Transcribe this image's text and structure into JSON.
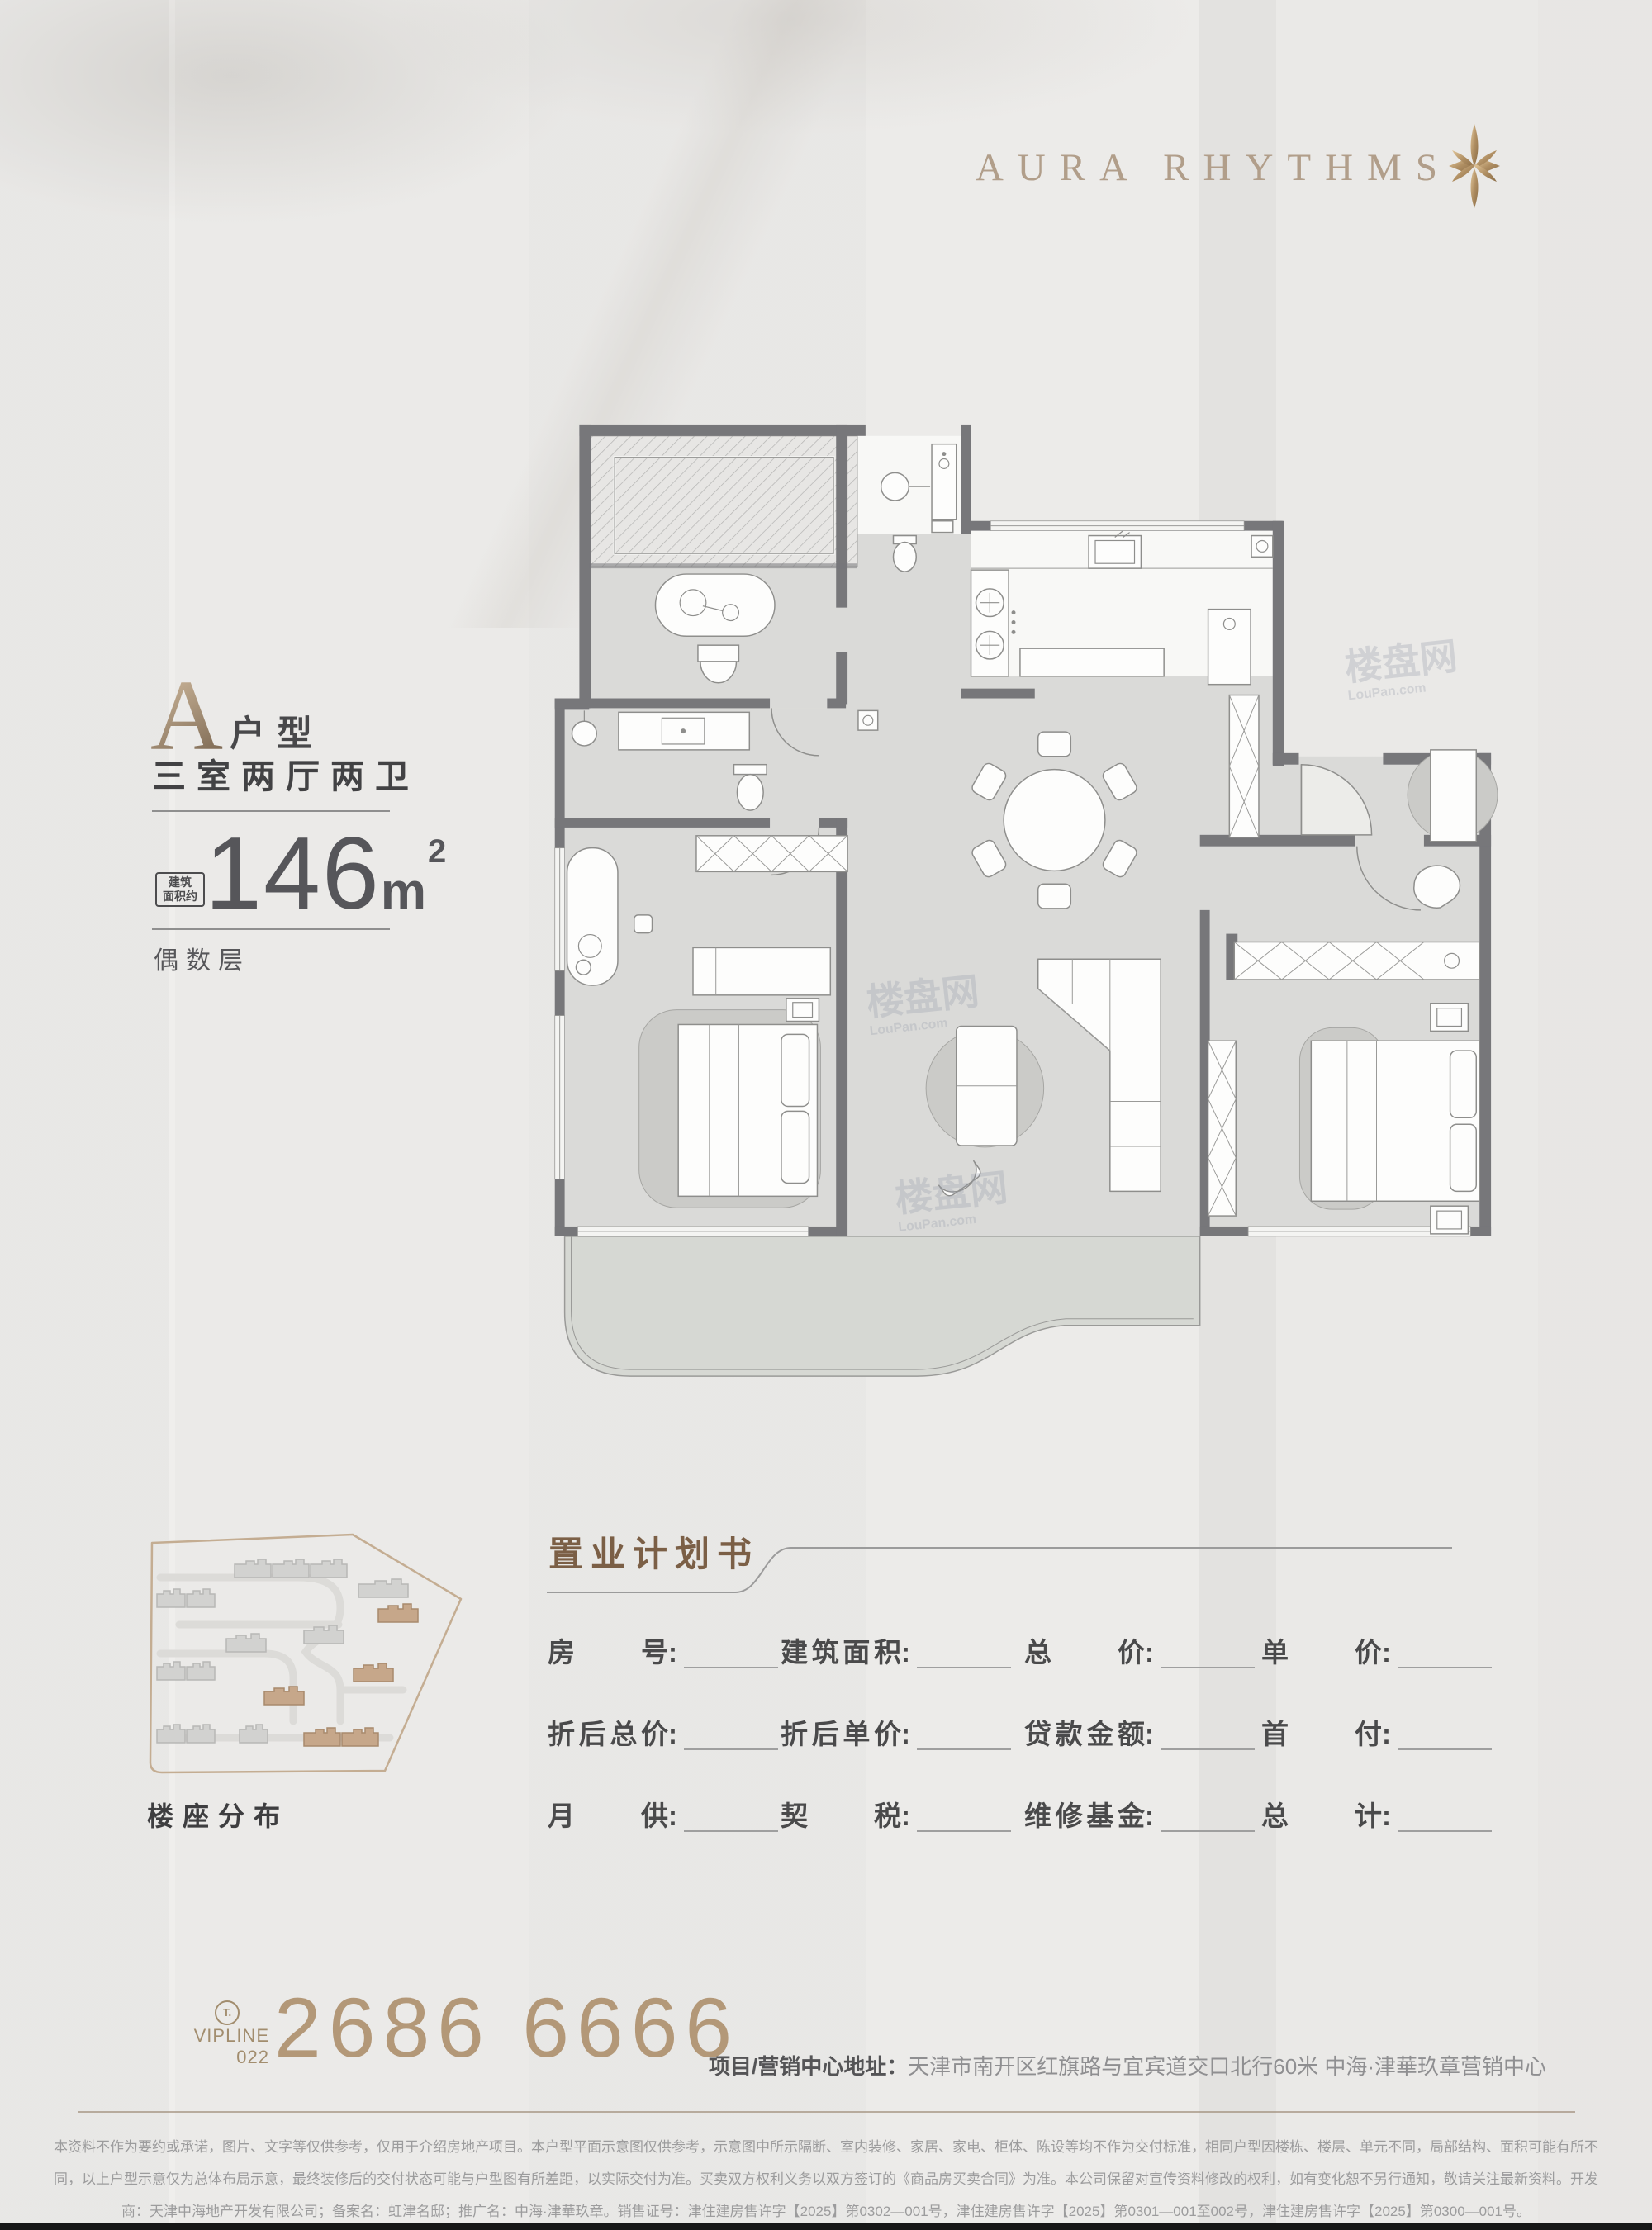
{
  "logo": {
    "text": "AURA RHYTHMS"
  },
  "unit": {
    "letter": "A",
    "suffix": "户型",
    "layout": "三室两厅两卫",
    "area": "146",
    "area_unit": "m",
    "area_exp": "2",
    "area_note1": "建筑",
    "area_note2": "面积约",
    "floor_note": "偶数层"
  },
  "floorplan": {
    "watermark": "楼盘网",
    "watermark_sub": "LouPan.com"
  },
  "sitemap": {
    "label": "楼座分布"
  },
  "form": {
    "title": "置业计划书",
    "fields": [
      "房号",
      "建筑面积",
      "总价",
      "单价",
      "折后总价",
      "折后单价",
      "贷款金额",
      "首付",
      "月供",
      "契税",
      "维修基金",
      "总计"
    ]
  },
  "footer": {
    "t_icon": "T.",
    "vipline": "VIPLINE",
    "area_code": "022",
    "phone": "2686 6666",
    "address_label": "项目/营销中心地址：",
    "address": "天津市南开区红旗路与宜宾道交口北行60米 中海·津華玖章营销中心"
  },
  "disclaimer": {
    "line1": "本资料不作为要约或承诺，图片、文字等仅供参考，仅用于介绍房地产项目。本户型平面示意图仅供参考，示意图中所示隔断、室内装修、家居、家电、柜体、陈设等均不作为交付标准，相同户型因楼栋、楼层、单元不同，局部结构、面积可能有所不",
    "line2": "同，以上户型示意仅为总体布局示意，最终装修后的交付状态可能与户型图有所差距，以实际交付为准。买卖双方权利义务以双方签订的《商品房买卖合同》为准。本公司保留对宣传资料修改的权利，如有变化恕不另行通知，敬请关注最新资料。开发",
    "line3": "商：天津中海地产开发有限公司；备案名：虹津名邸；推广名：中海·津華玖章。销售证号：津住建房售许字【2025】第0302—001号，津住建房售许字【2025】第0301—001至002号，津住建房售许字【2025】第0300—001号。"
  },
  "colors": {
    "accent_gold": "#b39878",
    "logo_tan": "#b19e8a",
    "title_brown": "#7b5f46",
    "wall_gray": "#77777a",
    "floor_gray": "#dadad8",
    "map_border_tan": "#c4ad92",
    "map_building_tan": "#c6a78a"
  }
}
